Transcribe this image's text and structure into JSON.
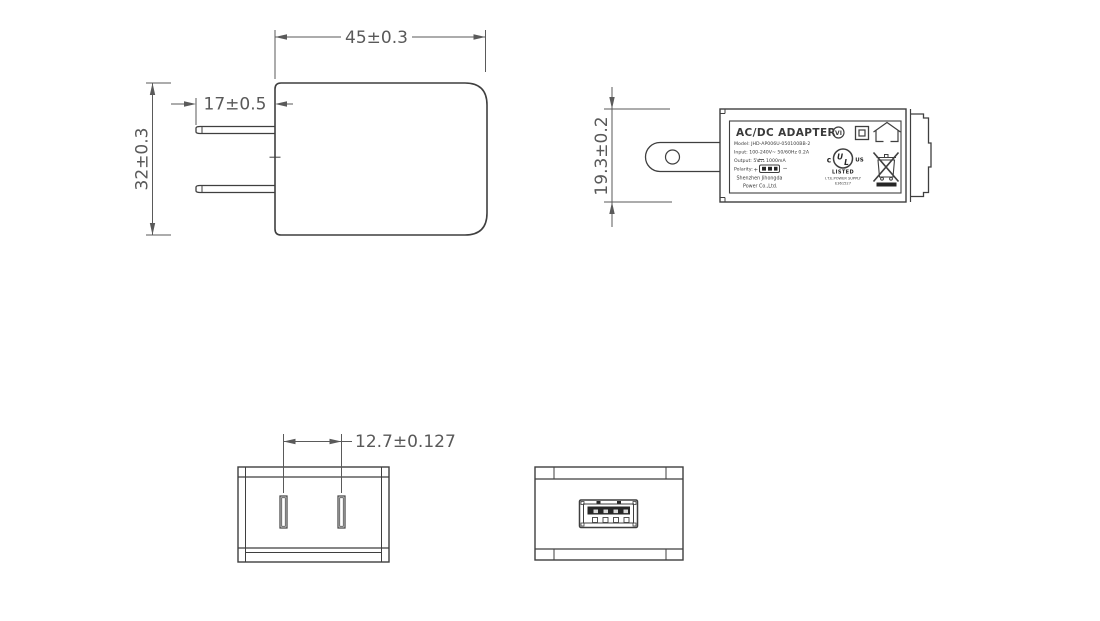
{
  "drawing_title": "AC/DC adapter dimensional drawing",
  "colors": {
    "line": "#3f3f3f",
    "dimension": "#5a5a5a",
    "dark_fill": "#262626",
    "background": "#ffffff"
  },
  "front_view": {
    "dim_width": "45±0.3",
    "dim_prong_length": "17±0.5",
    "dim_height": "32±0.3"
  },
  "side_view": {
    "dim_thickness": "19.3±0.2",
    "label": {
      "title": "AC/DC ADAPTER",
      "model": "Model: JHD-AP006U-050100BB-2",
      "input": "Input: 100-240V~ 50/60Hz 0.2A",
      "output_left": "Output: 5V",
      "output_right": "1000mA",
      "polarity": "Polarity:",
      "polarity_plus": "+",
      "polarity_minus": "−",
      "company_line1": "Shenzhen Jihongda",
      "company_line2": "Power Co.,Ltd.",
      "efficiency_mark": "VI",
      "ul_c": "c",
      "ul_u": "U",
      "ul_l": "L",
      "ul_us": "US",
      "ul_listed": "LISTED",
      "ul_category": "I.T.E.POWER SUPPLY",
      "ul_file": "E361527"
    }
  },
  "bottom_view": {
    "dim_prong_spacing": "12.7±0.127"
  },
  "icons": {
    "efficiency_vi": "roman-numeral-VI-in-circle",
    "class2_insulation": "square-in-square",
    "indoor_use": "house-outline",
    "ul_listed_mark": "cULus-listed-circle",
    "weee": "crossed-out-wheelie-bin-with-bar",
    "usb_connector": "usb-a-receptacle"
  }
}
